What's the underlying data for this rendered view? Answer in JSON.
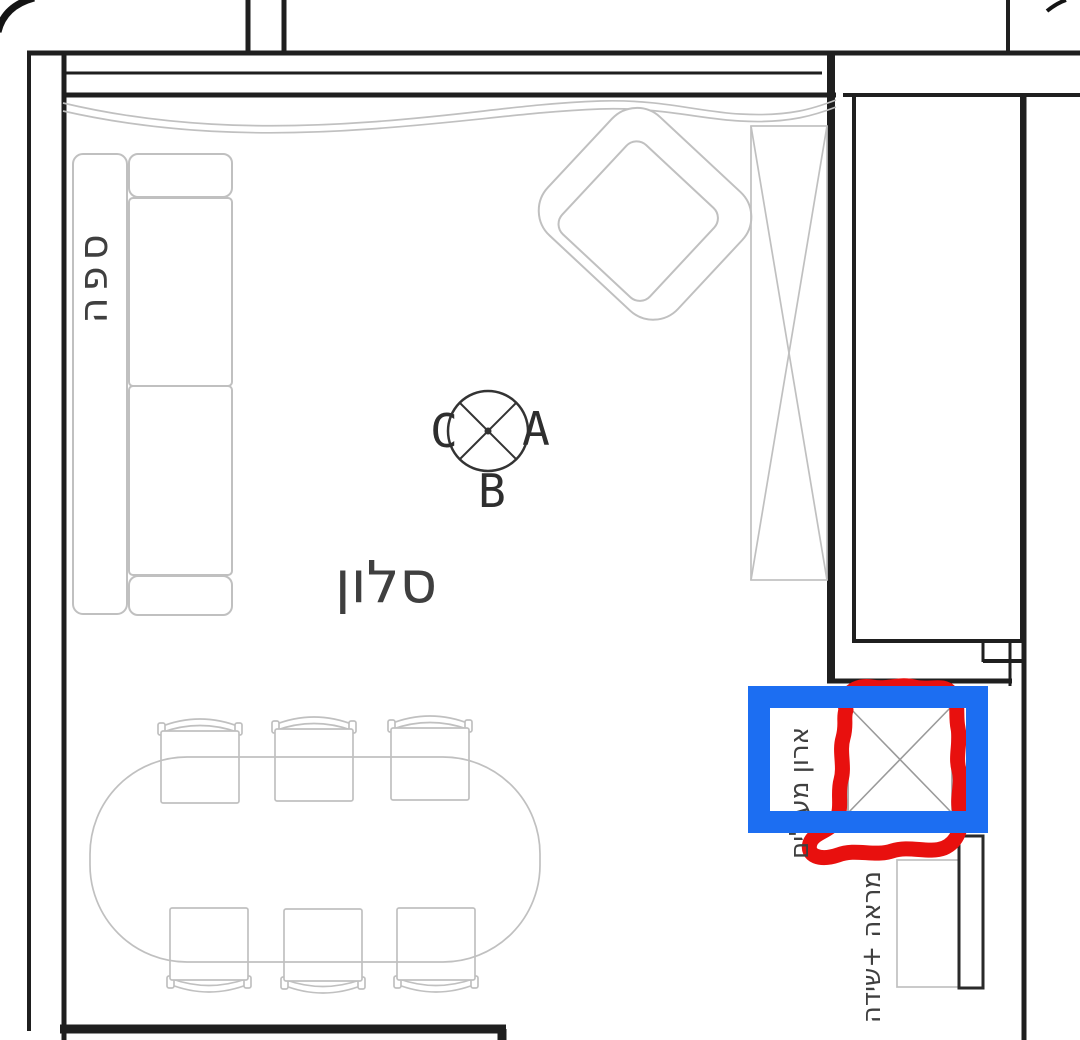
{
  "room": {
    "name_label": "סלון"
  },
  "furniture_labels": {
    "sofa": "ספה",
    "coat_closet": "ארון מעילים",
    "mirror_dresser": "מראה +שידה"
  },
  "ceiling_light": {
    "letter_left": "C",
    "letter_right": "A",
    "letter_bottom": "B"
  },
  "colors": {
    "annotation-blue": "#1c6ef2",
    "annotation-red": "#e8100e",
    "wall-line": "#1f1f1f",
    "furniture-line": "#c0c0c0",
    "label-text": "#3f3f3f"
  }
}
